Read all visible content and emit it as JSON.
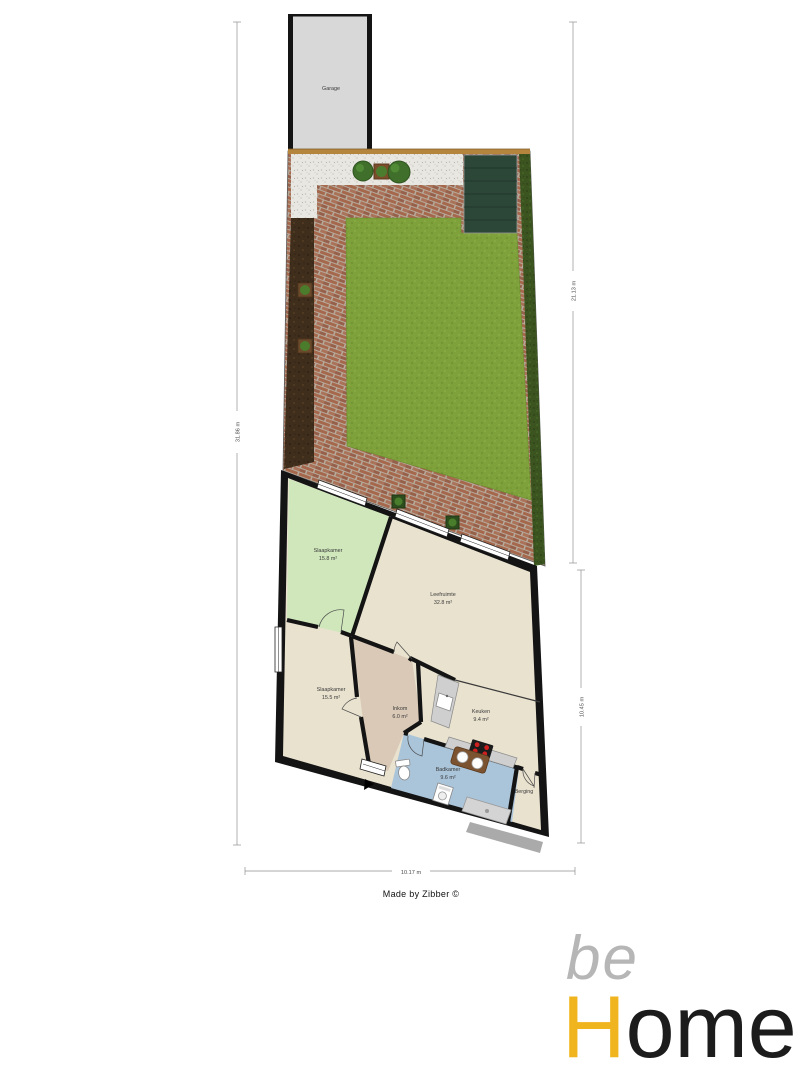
{
  "garage": {
    "label": "Garage"
  },
  "rooms": {
    "slaapkamer1": {
      "name": "Slaapkamer",
      "area": "15.8 m²",
      "color": "#cfe7bb"
    },
    "leefruimte": {
      "name": "Leefruimte",
      "area": "32.8 m²",
      "color": "#e9e2cf"
    },
    "slaapkamer2": {
      "name": "Slaapkamer",
      "area": "15.5 m²",
      "color": "#e9e2cf"
    },
    "inkom": {
      "name": "Inkom",
      "area": "6.0 m²",
      "color": "#d9c9b6"
    },
    "keuken": {
      "name": "Keuken",
      "area": "9.4 m²",
      "color": "#e9e2cf"
    },
    "badkamer": {
      "name": "Badkamer",
      "area": "9.6 m²",
      "color": "#aac4da"
    },
    "berging": {
      "name": "Berging",
      "color": "#e9e2cf"
    }
  },
  "garden": {
    "colors": {
      "lawn": "#7ea13b",
      "paving_brick": "#a5684c",
      "grout": "#b6aa9c",
      "gravel": "#e9e7e1",
      "soil": "#402e1d",
      "hedge": "#3c5520",
      "shed": "#2c4638",
      "fence": "#b5853e",
      "garage_floor": "#d8d8d8"
    }
  },
  "dimensions": {
    "left": "31.86 m",
    "right_upper": "21.13 m",
    "right_lower": "10.45 m",
    "bottom": "10.17 m"
  },
  "credit": "Made by Zibber ©",
  "logo": {
    "be": "be",
    "h": "H",
    "ome": "ome",
    "accent": "#F0B41E",
    "gray": "#b6b6b6",
    "dark": "#1c1c1c"
  }
}
